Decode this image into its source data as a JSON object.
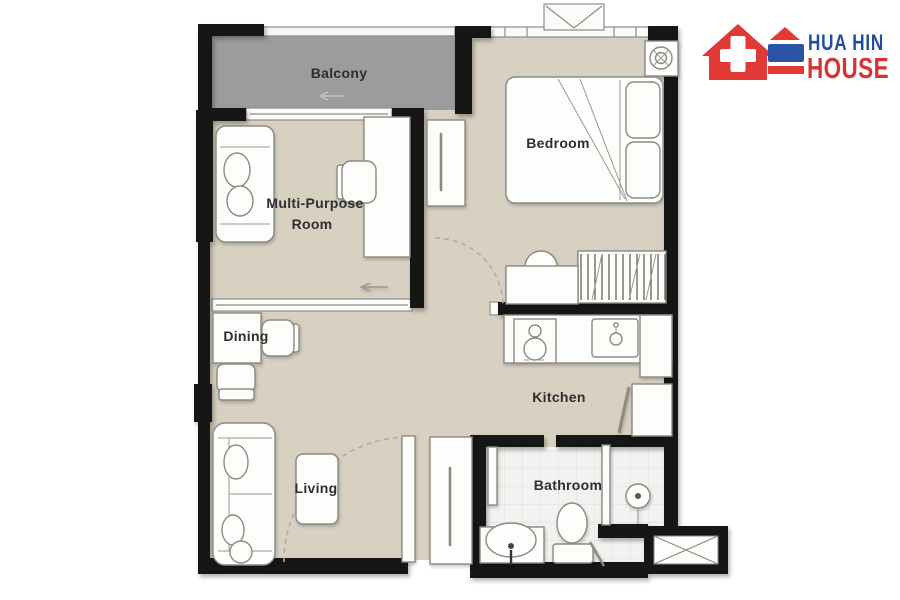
{
  "page": {
    "background_color": "#ffffff"
  },
  "brand": {
    "name_line1": "HUA HIN",
    "name_line2": "HOUSE",
    "line1_color": "#1e4e9c",
    "line2_color": "#d53434",
    "icon_color_red": "#e13a36",
    "icon_color_blue": "#2a55a4"
  },
  "icons": {
    "logo": "house-with-cross-icon",
    "bedroom_corner": "ceiling-fan-ac-icon",
    "roof_units": "condenser-x-box-icon"
  },
  "floorplan": {
    "labels": {
      "balcony": "Balcony",
      "multi_purpose_line1": "Multi-Purpose",
      "multi_purpose_line2": "Room",
      "bedroom": "Bedroom",
      "dining": "Dining",
      "kitchen": "Kitchen",
      "living": "Living",
      "bathroom": "Bathroom"
    },
    "colors": {
      "wall": "#161616",
      "floor": "#d8d1c2",
      "balcony_floor": "#9c9c9c",
      "bathroom_tile": "#f2f2f0",
      "furniture_fill": "#fdfdfb",
      "furniture_stroke": "#8b8b83",
      "label_color": "#2e2e2e"
    }
  }
}
